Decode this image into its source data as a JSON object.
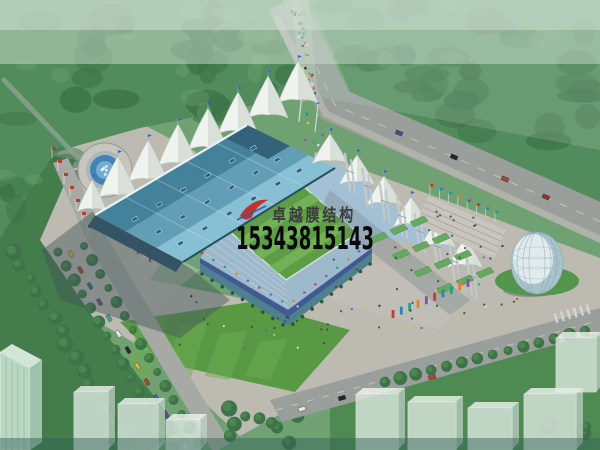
{
  "meta": {
    "description": "Aerial architectural rendering of a membrane-structure stadium complex with surrounding plazas, roads, fountain and glass egg pavilion",
    "rendering_type": "photo-like 3D rendering, no UI chrome"
  },
  "watermark": {
    "company_name": "卓越膜结构",
    "phone_number": "15343815143",
    "logo_icon": "red-swoosh-logo",
    "company_text_color": "#3b3b40",
    "phone_text_color": "#0a0a0c",
    "logo_red": "#c0322a",
    "logo_blue": "#2b5fb0"
  },
  "palette": {
    "forest_base": "#4f8a58",
    "forest_dark": "#386f44",
    "forest_light": "#6ba36e",
    "haze": "#cfe0d3",
    "road": "#999e9b",
    "road_sidewalk": "#b3b5ae",
    "road_dash": "#cacec8",
    "plaza": "#bdbab2",
    "plaza_light": "#c9c6be",
    "lawn": "#55973f",
    "lawn_stripe": "#68ab4e",
    "grass_dark": "#3f7a46",
    "roof_dark": "#3f7e99",
    "roof_mid": "#5f9cb8",
    "roof_light": "#85bfd6",
    "roof_tip": "#2c5e79",
    "roof_edge": "#1f4a5e",
    "tent_white": "#f3f6f1",
    "tent_shade": "#c7d2cb",
    "field_a": "#5a9a40",
    "field_b": "#6fb052",
    "seat_blue": "#a4c0d6",
    "seat_blue2": "#8fb2cc",
    "facade_glass": "#4a7d8c",
    "banner_blue": "#3a4f92",
    "water": "#3e7fb5",
    "water_light": "#72aad6",
    "shadow": "#3c4e55",
    "mast": "#c3c9ce",
    "terrace_green": "#63a85c",
    "egg_light": "#eef5f6",
    "egg_mid": "#a9c3cd",
    "ghost": "#e4ede8",
    "ghost_side": "#c6d6cd",
    "building_green": "#bcd9c6",
    "flag_red": "#c23227",
    "car_colors": [
      "#d4b93c",
      "#b03a30",
      "#3b5fa8",
      "#6a3f9e",
      "#3f9e8e",
      "#e8e8e8",
      "#222222"
    ],
    "banner_colors": [
      "#c0392b",
      "#2980b9",
      "#16a085",
      "#e67e22",
      "#8e44ad"
    ],
    "crowd_colors": [
      "#c0392b",
      "#2d6cdf",
      "#e8c93e",
      "#e8e8e8",
      "#27ae60",
      "#8e44ad",
      "#1d1d22"
    ]
  },
  "scene_objects": [
    "forest",
    "main-road",
    "crowd-path",
    "fountain-plaza",
    "flag-poles",
    "stadium-blue-roof",
    "membrane-tents-northwest",
    "membrane-canopy-southeast",
    "steel-masts",
    "football-field",
    "grandstand-seating",
    "south-glass-facade",
    "green-terraces",
    "east-plaza",
    "tree-lined-parking-avenue",
    "glass-egg-pavilion",
    "ghost-buildings",
    "green-tower-building",
    "secondary-road",
    "crosswalk"
  ]
}
